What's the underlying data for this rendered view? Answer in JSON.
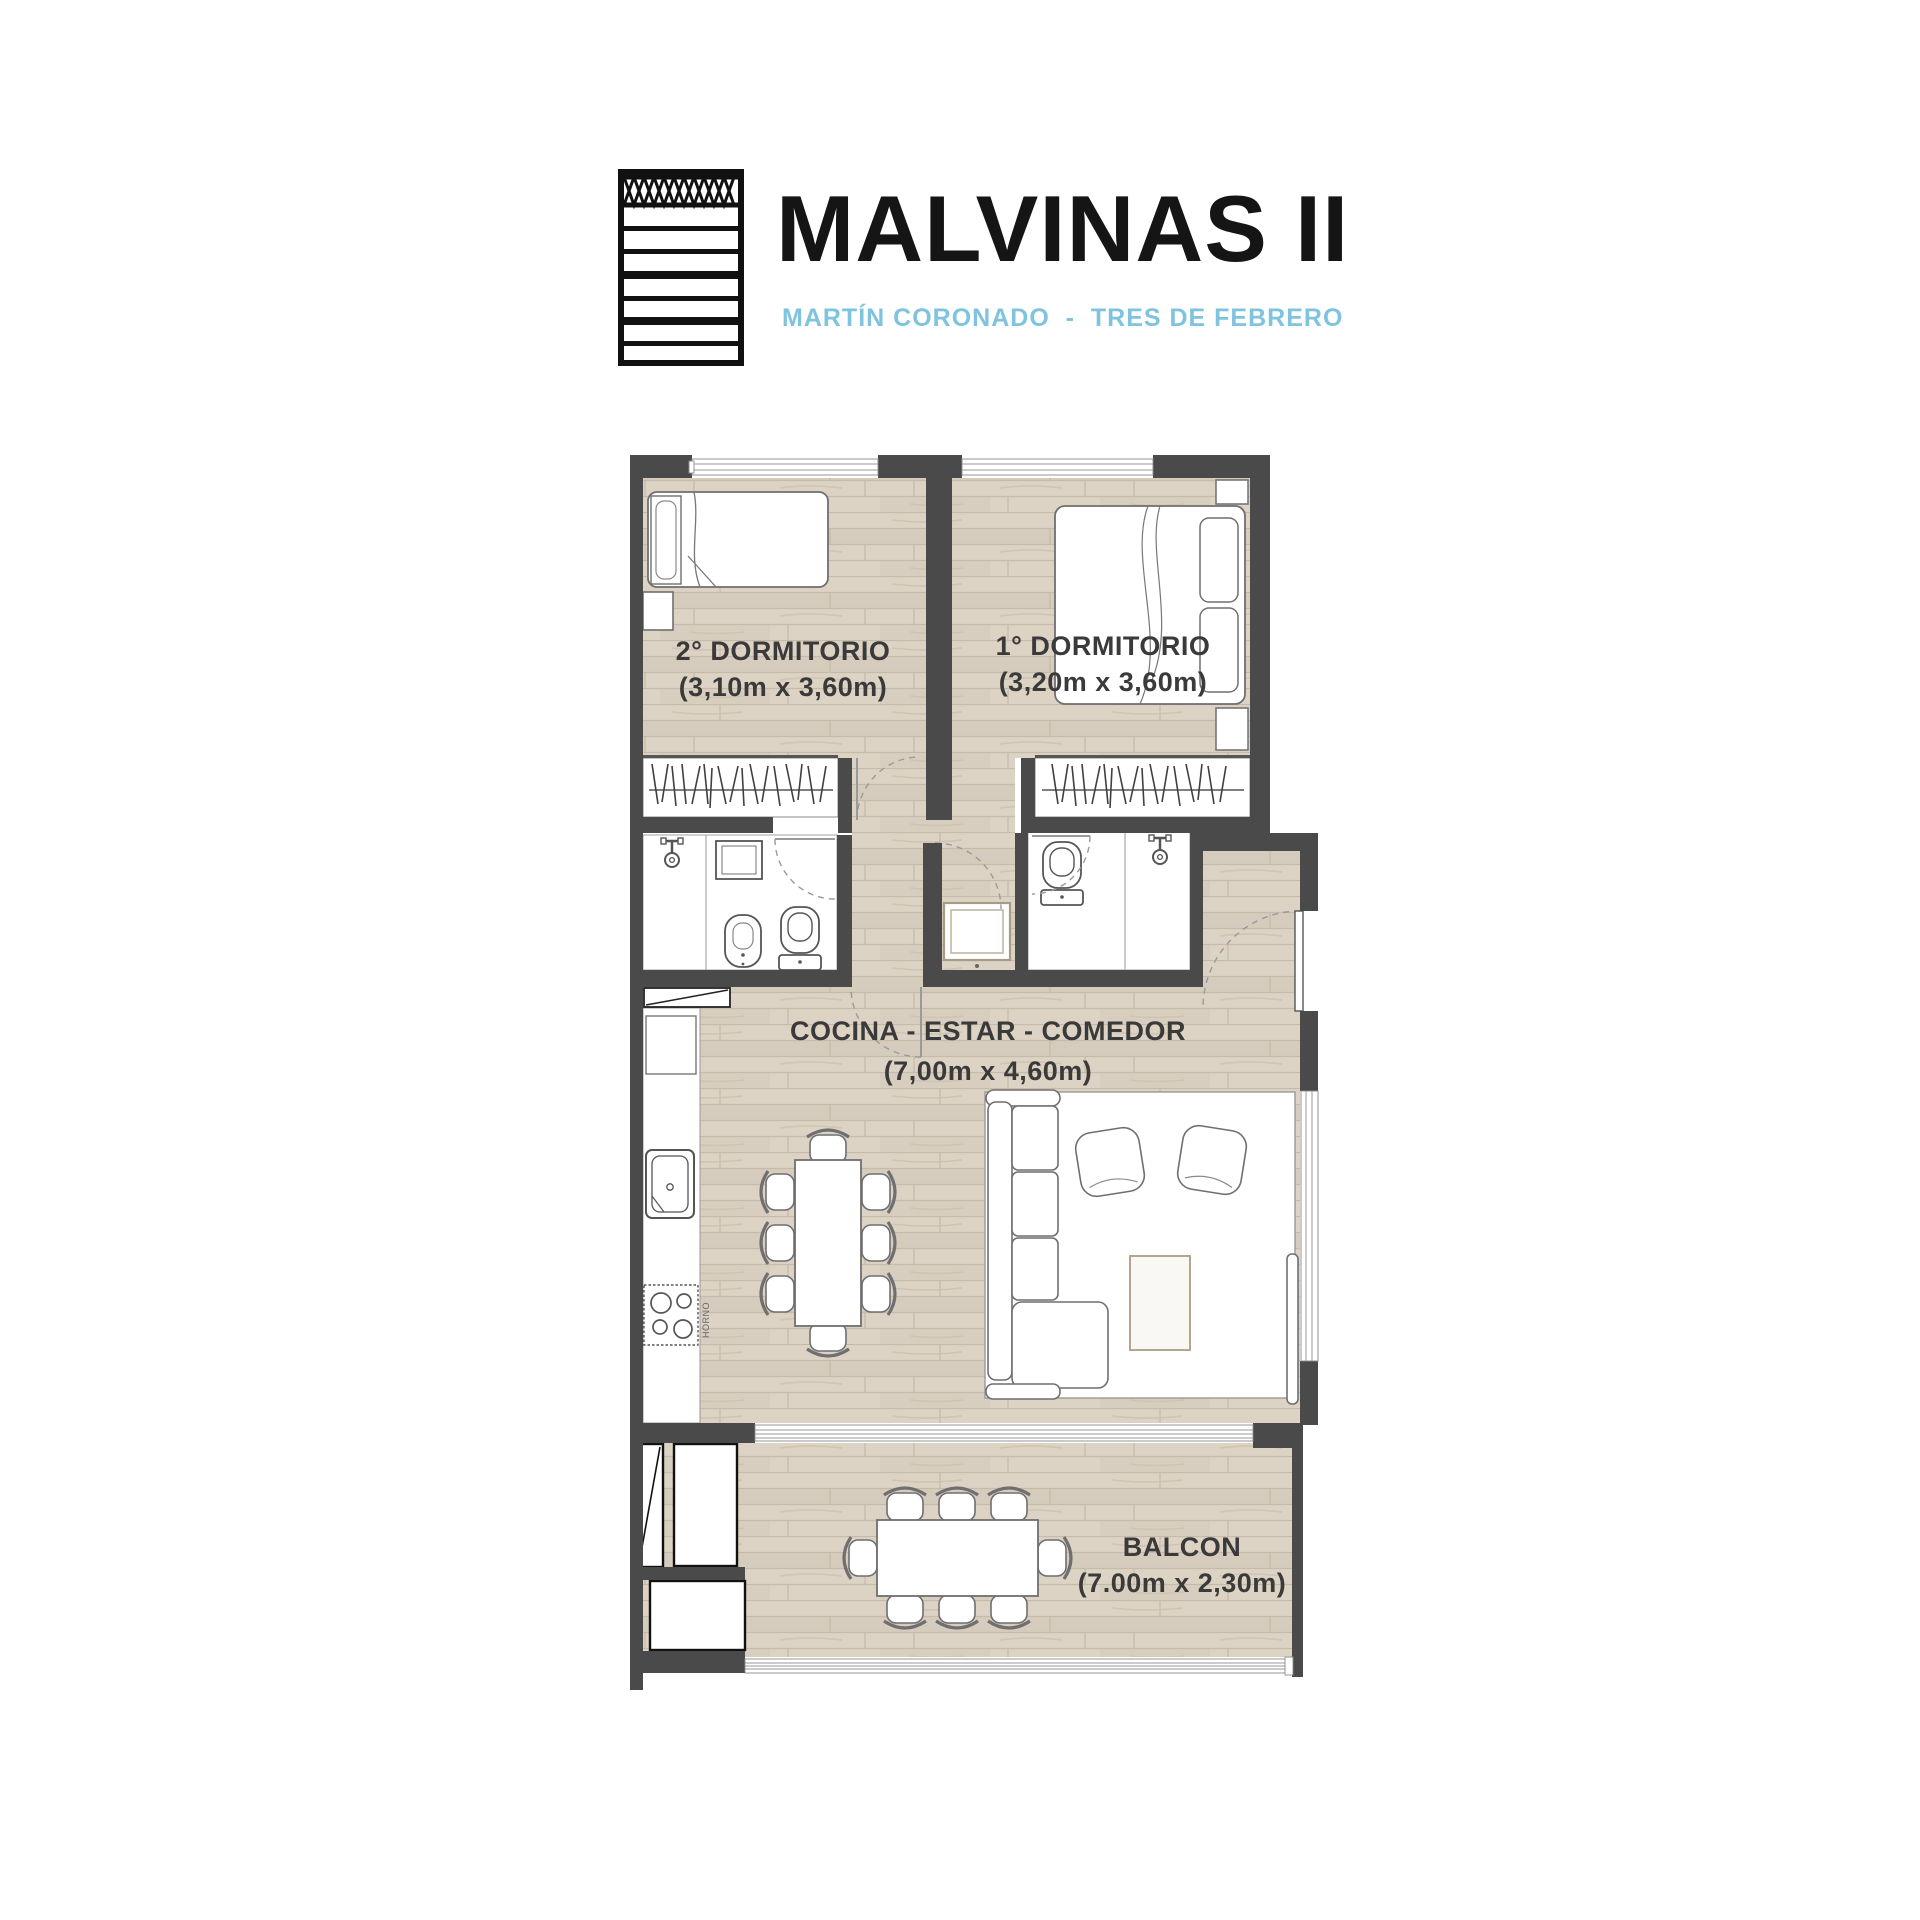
{
  "header": {
    "title": "MALVINAS II",
    "subtitle": "MARTÍN CORONADO  -  TRES DE FEBRERO",
    "logo_name": "building-facade-logo"
  },
  "plan": {
    "rooms": {
      "bedroom2": {
        "label": "2° DORMITORIO",
        "dims": "(3,10m x 3,60m)"
      },
      "bedroom1": {
        "label": "1° DORMITORIO",
        "dims": "(3,20m x 3,60m)"
      },
      "living": {
        "label": "COCINA - ESTAR - COMEDOR",
        "dims": "(7,00m x 4,60m)"
      },
      "balcony": {
        "label": "BALCON",
        "dims": "(7.00m x 2,30m)"
      }
    },
    "stove_label": "HORNO",
    "colors": {
      "wall": "#4a4a4b",
      "floor_base": "#dcd3c5",
      "floor_line": "#c6baa8",
      "accent_subtitle": "#7fc3de",
      "label_text": "#3a3a3a"
    }
  }
}
